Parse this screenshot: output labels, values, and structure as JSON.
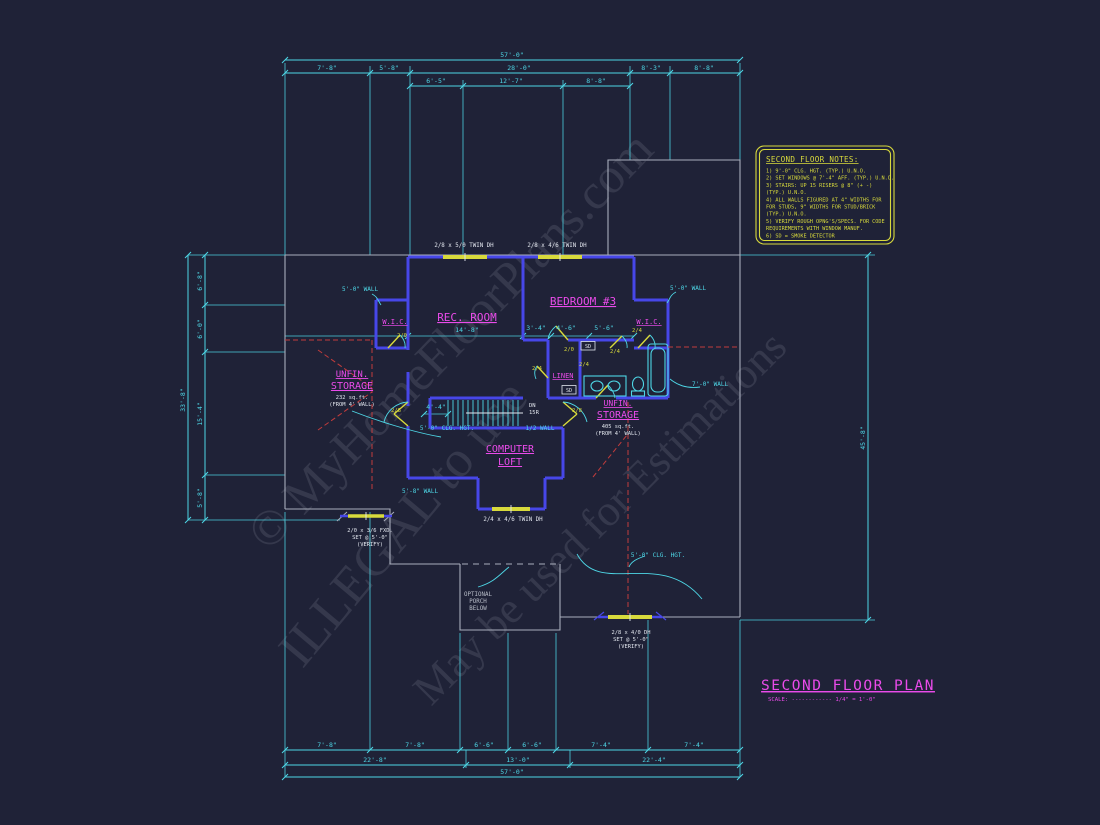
{
  "colors": {
    "bg": "#1f2237",
    "cy": "#4ed7e6",
    "mg": "#ea4bea",
    "yl": "#d8da3c",
    "wh": "#e2e6ee",
    "gy": "#b9bec9",
    "rd": "#c23c3c",
    "bl": "#4747e8",
    "outline": "#a9aebc",
    "wm": "#c6ccda"
  },
  "watermarks": [
    {
      "text": "© MyHomeFloorPlans.com",
      "x": 462,
      "y": 352,
      "rot": -46,
      "size": 50
    },
    {
      "text": "ILLEGAL to use",
      "x": 416,
      "y": 534,
      "rot": -50,
      "size": 52
    },
    {
      "text": "May be used for Estimations",
      "x": 610,
      "y": 528,
      "rot": -45,
      "size": 44
    }
  ],
  "notes": {
    "heading": "SECOND FLOOR NOTES:",
    "lines": [
      "1) 9'-0\" CLG. HGT. (TYP.) U.N.O.",
      "2) SET WINDOWS @ 7'-4\" AFF. (TYP.) U.N.O.",
      "3) STAIRS: UP 15 RISERS @ 8\" (+ -)",
      "    (TYP.) U.N.O.",
      "4) ALL WALLS FIGURED AT 4\" WIDTHS FOR",
      "    FOR STUDS, 9\" WIDTHS FOR STUD/BRICK",
      "    (TYP.) U.N.O.",
      "5) VERIFY ROUGH OPNG'S/SPECS. FOR CODE",
      "    REQUIREMENTS WITH WINDOW MANUF.",
      "6) SD = SMOKE DETECTOR"
    ]
  },
  "labels": [
    {
      "t": "57'-0\"",
      "x": 512,
      "y": 57
    },
    {
      "t": "7'-8\"",
      "x": 327,
      "y": 70
    },
    {
      "t": "5'-8\"",
      "x": 389,
      "y": 70
    },
    {
      "t": "28'-0\"",
      "x": 519,
      "y": 70
    },
    {
      "t": "8'-3\"",
      "x": 651,
      "y": 70
    },
    {
      "t": "8'-8\"",
      "x": 704,
      "y": 70
    },
    {
      "t": "6'-5\"",
      "x": 436,
      "y": 83
    },
    {
      "t": "12'-7\"",
      "x": 511,
      "y": 83
    },
    {
      "t": "8'-8\"",
      "x": 596,
      "y": 83
    },
    {
      "t": "7'-8\"",
      "x": 327,
      "y": 747
    },
    {
      "t": "7'-8\"",
      "x": 415,
      "y": 747
    },
    {
      "t": "6'-6\"",
      "x": 484,
      "y": 747
    },
    {
      "t": "6'-6\"",
      "x": 532,
      "y": 747
    },
    {
      "t": "7'-4\"",
      "x": 601,
      "y": 747
    },
    {
      "t": "7'-4\"",
      "x": 694,
      "y": 747
    },
    {
      "t": "22'-8\"",
      "x": 375,
      "y": 762
    },
    {
      "t": "13'-0\"",
      "x": 518,
      "y": 762
    },
    {
      "t": "22'-4\"",
      "x": 654,
      "y": 762
    },
    {
      "t": "57'-0\"",
      "x": 512,
      "y": 774
    },
    {
      "t": "33'-8\"",
      "x": 185,
      "y": 400,
      "r": -90
    },
    {
      "t": "6'-8\"",
      "x": 202,
      "y": 281,
      "r": -90
    },
    {
      "t": "6'-0\"",
      "x": 202,
      "y": 329,
      "r": -90
    },
    {
      "t": "15'-4\"",
      "x": 202,
      "y": 414,
      "r": -90
    },
    {
      "t": "5'-8\"",
      "x": 202,
      "y": 498,
      "r": -90
    },
    {
      "t": "45'-8\"",
      "x": 865,
      "y": 438,
      "r": -90
    },
    {
      "t": "14'-8\"",
      "x": 467,
      "y": 332
    },
    {
      "t": "3'-4\"",
      "x": 536,
      "y": 330
    },
    {
      "t": "4'-6\"",
      "x": 566,
      "y": 330
    },
    {
      "t": "5'-6\"",
      "x": 604,
      "y": 330
    },
    {
      "t": "4'-4\"",
      "x": 436,
      "y": 409
    },
    {
      "t": "5'-0\" WALL",
      "x": 360,
      "y": 291,
      "s": 6
    },
    {
      "t": "5'-0\" WALL",
      "x": 688,
      "y": 290,
      "s": 6
    },
    {
      "t": "7'-0\" WALL",
      "x": 710,
      "y": 386,
      "s": 6
    },
    {
      "t": "5'-0\" CLG. HGT.",
      "x": 447,
      "y": 430,
      "s": 6
    },
    {
      "t": "1/2 WALL",
      "x": 540,
      "y": 430,
      "s": 6
    },
    {
      "t": "5'-8\" WALL",
      "x": 420,
      "y": 493,
      "s": 6
    },
    {
      "t": "5'-0\" CLG. HGT.",
      "x": 658,
      "y": 557,
      "s": 6
    },
    {
      "t": "DN",
      "x": 529,
      "y": 407,
      "c": "wh",
      "s": 5.5,
      "a": "start"
    },
    {
      "t": "15R",
      "x": 529,
      "y": 414,
      "c": "wh",
      "s": 5.5,
      "a": "start"
    },
    {
      "t": "OPTIONAL",
      "x": 478,
      "y": 596,
      "c": "gy",
      "s": 5.8
    },
    {
      "t": "PORCH",
      "x": 478,
      "y": 603,
      "c": "gy",
      "s": 5.8
    },
    {
      "t": "BELOW",
      "x": 478,
      "y": 610,
      "c": "gy",
      "s": 5.8
    },
    {
      "t": "2/0 x 3/6 FXD.",
      "x": 370,
      "y": 532,
      "c": "wh",
      "s": 5.4
    },
    {
      "t": "SET @ 5'-0\"",
      "x": 370,
      "y": 539,
      "c": "wh",
      "s": 5.4
    },
    {
      "t": "(VERIFY)",
      "x": 370,
      "y": 546,
      "c": "wh",
      "s": 5.4
    },
    {
      "t": "2/8 x 4/0 DH",
      "x": 631,
      "y": 634,
      "c": "wh",
      "s": 5.4
    },
    {
      "t": "SET @ 5'-0\"",
      "x": 631,
      "y": 641,
      "c": "wh",
      "s": 5.4
    },
    {
      "t": "(VERIFY)",
      "x": 631,
      "y": 648,
      "c": "wh",
      "s": 5.4
    },
    {
      "t": "2/8 x 5/0 TWIN DH",
      "x": 464,
      "y": 247,
      "c": "wh",
      "s": 5.8
    },
    {
      "t": "2/8 x 4/6 TWIN DH",
      "x": 557,
      "y": 247,
      "c": "wh",
      "s": 5.8
    },
    {
      "t": "2/4 x 4/6 TWIN DH",
      "x": 513,
      "y": 521,
      "c": "wh",
      "s": 5.8
    },
    {
      "n": "smoke-detector-label",
      "t": "SD",
      "x": 588,
      "y": 348,
      "c": "wh",
      "s": 5
    },
    {
      "n": "smoke-detector-label",
      "t": "SD",
      "x": 569,
      "y": 392,
      "c": "wh",
      "s": 5
    },
    {
      "t": "2/0",
      "x": 402,
      "y": 337,
      "c": "yl",
      "s": 5.5
    },
    {
      "t": "2/8",
      "x": 396,
      "y": 412,
      "c": "yl",
      "s": 5.5
    },
    {
      "t": "2/8",
      "x": 577,
      "y": 412,
      "c": "yl",
      "s": 5.5
    },
    {
      "t": "2/4",
      "x": 537,
      "y": 370,
      "c": "yl",
      "s": 5.5
    },
    {
      "t": "2/4",
      "x": 584,
      "y": 366,
      "c": "yl",
      "s": 5.5
    },
    {
      "t": "2/4",
      "x": 615,
      "y": 353,
      "c": "yl",
      "s": 5.5
    },
    {
      "t": "2/4",
      "x": 637,
      "y": 332,
      "c": "yl",
      "s": 5.5
    },
    {
      "t": "2/0",
      "x": 569,
      "y": 351,
      "c": "yl",
      "s": 5.5
    },
    {
      "n": "room-label-rec-room",
      "t": "REC. ROOM",
      "x": 467,
      "y": 321,
      "c": "mg",
      "s": 11,
      "u": true
    },
    {
      "n": "room-label-bedroom-3",
      "t": "BEDROOM #3",
      "x": 583,
      "y": 305,
      "c": "mg",
      "s": 11,
      "u": true
    },
    {
      "n": "room-label-wic-left",
      "t": "W.I.C.",
      "x": 395,
      "y": 324,
      "c": "mg",
      "s": 7,
      "u": true
    },
    {
      "n": "room-label-wic-right",
      "t": "W.I.C.",
      "x": 649,
      "y": 324,
      "c": "mg",
      "s": 7,
      "u": true
    },
    {
      "n": "room-label-linen",
      "t": "LINEN",
      "x": 563,
      "y": 378,
      "c": "mg",
      "s": 7,
      "u": true
    },
    {
      "n": "room-label-storage-left",
      "t": "UNFIN.",
      "x": 352,
      "y": 377,
      "c": "mg",
      "s": 9,
      "u": true
    },
    {
      "t": "STORAGE",
      "x": 352,
      "y": 389,
      "c": "mg",
      "s": 10,
      "u": true
    },
    {
      "t": "232 sq.ft.",
      "x": 352,
      "y": 399,
      "c": "wh",
      "s": 5.4
    },
    {
      "t": "(FROM 4' WALL)",
      "x": 352,
      "y": 406,
      "c": "wh",
      "s": 5.4
    },
    {
      "n": "room-label-storage-right",
      "t": "UNFIN.",
      "x": 618,
      "y": 406,
      "c": "mg",
      "s": 8,
      "u": true
    },
    {
      "t": "STORAGE",
      "x": 618,
      "y": 418,
      "c": "mg",
      "s": 10,
      "u": true
    },
    {
      "t": "405 sq.ft.",
      "x": 618,
      "y": 428,
      "c": "wh",
      "s": 5.4
    },
    {
      "t": "(FROM 4' WALL)",
      "x": 618,
      "y": 435,
      "c": "wh",
      "s": 5.4
    },
    {
      "n": "room-label-computer-loft",
      "t": "COMPUTER",
      "x": 510,
      "y": 452,
      "c": "mg",
      "s": 10,
      "u": true
    },
    {
      "t": "LOFT",
      "x": 510,
      "y": 465,
      "c": "mg",
      "s": 10,
      "u": true
    },
    {
      "n": "plan-title",
      "t": "SECOND FLOOR PLAN",
      "x": 848,
      "y": 690,
      "c": "mg",
      "s": 14.5,
      "u": true,
      "ls": 1.5
    },
    {
      "n": "scale-label",
      "t": "SCALE: ------------ 1/4\" = 1'-0\"",
      "x": 768,
      "y": 701,
      "c": "mg",
      "s": 5.6,
      "a": "start"
    }
  ]
}
